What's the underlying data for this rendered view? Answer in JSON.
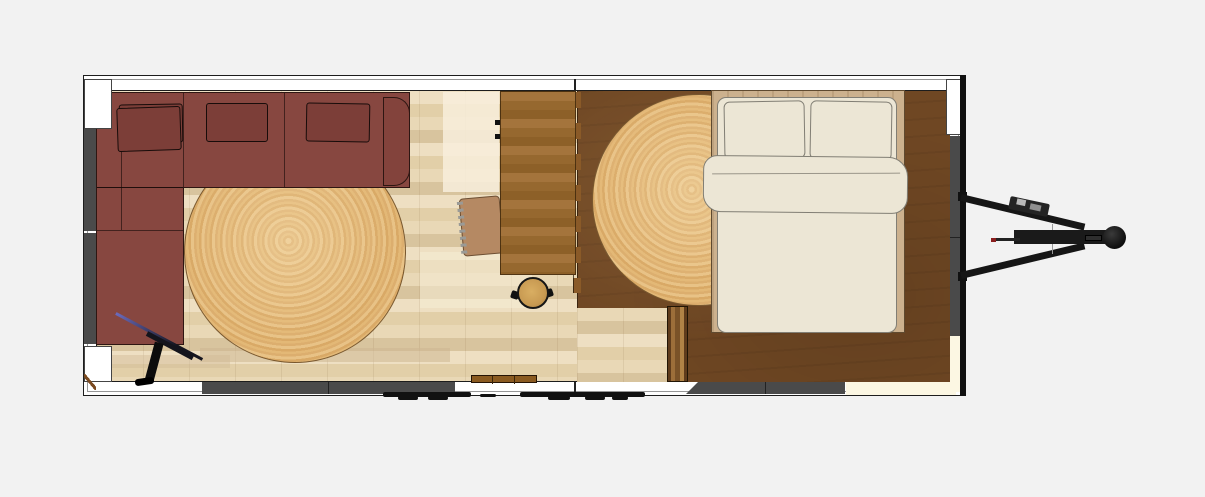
{
  "scene": {
    "type": "floor-plan",
    "view": "top-down",
    "subject": "tiny house on trailer with living area, desk nook and bedroom",
    "text_visible": "none"
  },
  "palette": {
    "bg": "#f2f2f2",
    "wall": "#ffffff",
    "line": "#1d1d1d",
    "panel": "#4a4a4a",
    "door": "#fcf7e3",
    "fla": "#eedfc2",
    "flb": "#e2cfa8",
    "flc": "#e9d8b6",
    "fld": "#d8c49e",
    "fdk": "#6f4723",
    "ladder": "#8a5a28",
    "bencha": "#9c6e3a",
    "benchb": "#5f3c1c",
    "ruga": "#e8c286",
    "rugb": "#d9a966",
    "rugc": "#e3b876",
    "deska": "#a4743c",
    "deskb": "#8d6028",
    "chair": "#b58963",
    "stool": "#c89a52",
    "sofa": "#874740",
    "sofadk": "#7c3e38",
    "frame": "#ccb18e",
    "bedding": "#ece6d5",
    "bedline": "#817e74",
    "hitch": "#161616",
    "red": "#8a1f1f",
    "steel": "#6b6bbd"
  },
  "rooms": [
    {
      "name": "living-area",
      "floor": "light oak plank flooring"
    },
    {
      "name": "bedroom",
      "floor": "dark walnut flooring"
    }
  ],
  "objects": {
    "sofa": "L-shaped maroon sectional sofa with three back pillows and chaise",
    "rug_living": "round woven jute rug (living area)",
    "rug_bedroom": "round woven jute rug (bedroom, tucked under bed)",
    "desk": "butcher-block desk counter",
    "chair": "desk chair",
    "stool": "round wooden stool",
    "ladder": "loft ladder on partition wall",
    "bench": "narrow wooden step bench",
    "bed": "double bed with cream duvet, folded top edge and two pillows",
    "tripod": "black tripod floor stand on chaise",
    "shelf": "small wall-mounted wooden board",
    "wheel_wells": "dark gray wheel-well / utility panels in walls",
    "doors_cream": "ivory door panels (right and bottom-right walls)",
    "hitch": "A-frame trailer tongue with jack winch, drawbar and coupler ball"
  }
}
